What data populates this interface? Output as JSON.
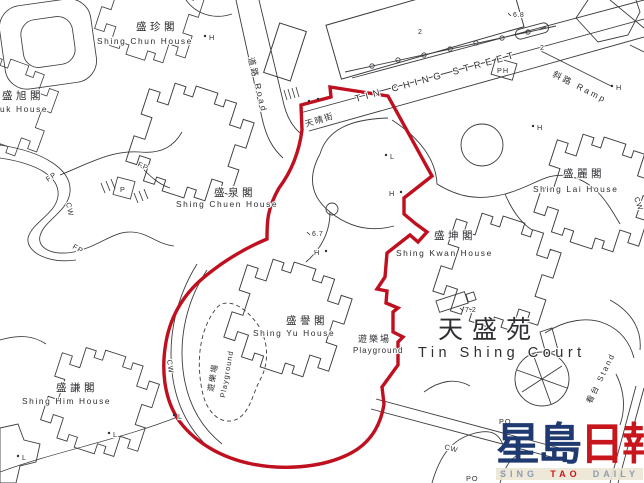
{
  "map": {
    "houses": [
      {
        "id": "shing-chun",
        "cn": "盛珍閣",
        "en": "Shing Chun House"
      },
      {
        "id": "shing-yuk",
        "cn": "盛旭閣",
        "en": "uk House"
      },
      {
        "id": "shing-chuen",
        "cn": "盛泉閣",
        "en": "Shing Chuen House"
      },
      {
        "id": "shing-yu",
        "cn": "盛譽閣",
        "en": "Shing Yu House"
      },
      {
        "id": "shing-kwan",
        "cn": "盛坤閣",
        "en": "Shing Kwan House"
      },
      {
        "id": "shing-lai",
        "cn": "盛麗閣",
        "en": "Shing Lai House"
      },
      {
        "id": "shing-him",
        "cn": "盛謙閣",
        "en": "Shing Him House"
      }
    ],
    "court": {
      "cn": "天盛苑",
      "en": "Tin Shing Court"
    },
    "street": {
      "en": "TIN CHING STREET",
      "cn": "天晴街"
    },
    "road": {
      "label": "道路 Road"
    },
    "ramp": {
      "label": "斜路 Ramp"
    },
    "playground_area": {
      "cn": "遊樂場",
      "en": "Playground"
    },
    "stand": {
      "label": "看台 Stand"
    },
    "markers": {
      "ph": "PH",
      "p": "P",
      "fp": "FP",
      "cw": "CW",
      "po": "PO",
      "h": "H",
      "l": "L"
    },
    "spot_heights": {
      "h68": "6.8",
      "h67": "6.7",
      "h72": "7.2",
      "n2": "2"
    }
  },
  "watermark": {
    "cn_left": "星島",
    "cn_right": "日報",
    "en": [
      "SING",
      "TAO",
      "DAILY"
    ],
    "navy": "#1f3a70",
    "red": "#c8161d"
  },
  "colors": {
    "boundary_red": "#c01020",
    "line": "#3c3c40"
  }
}
